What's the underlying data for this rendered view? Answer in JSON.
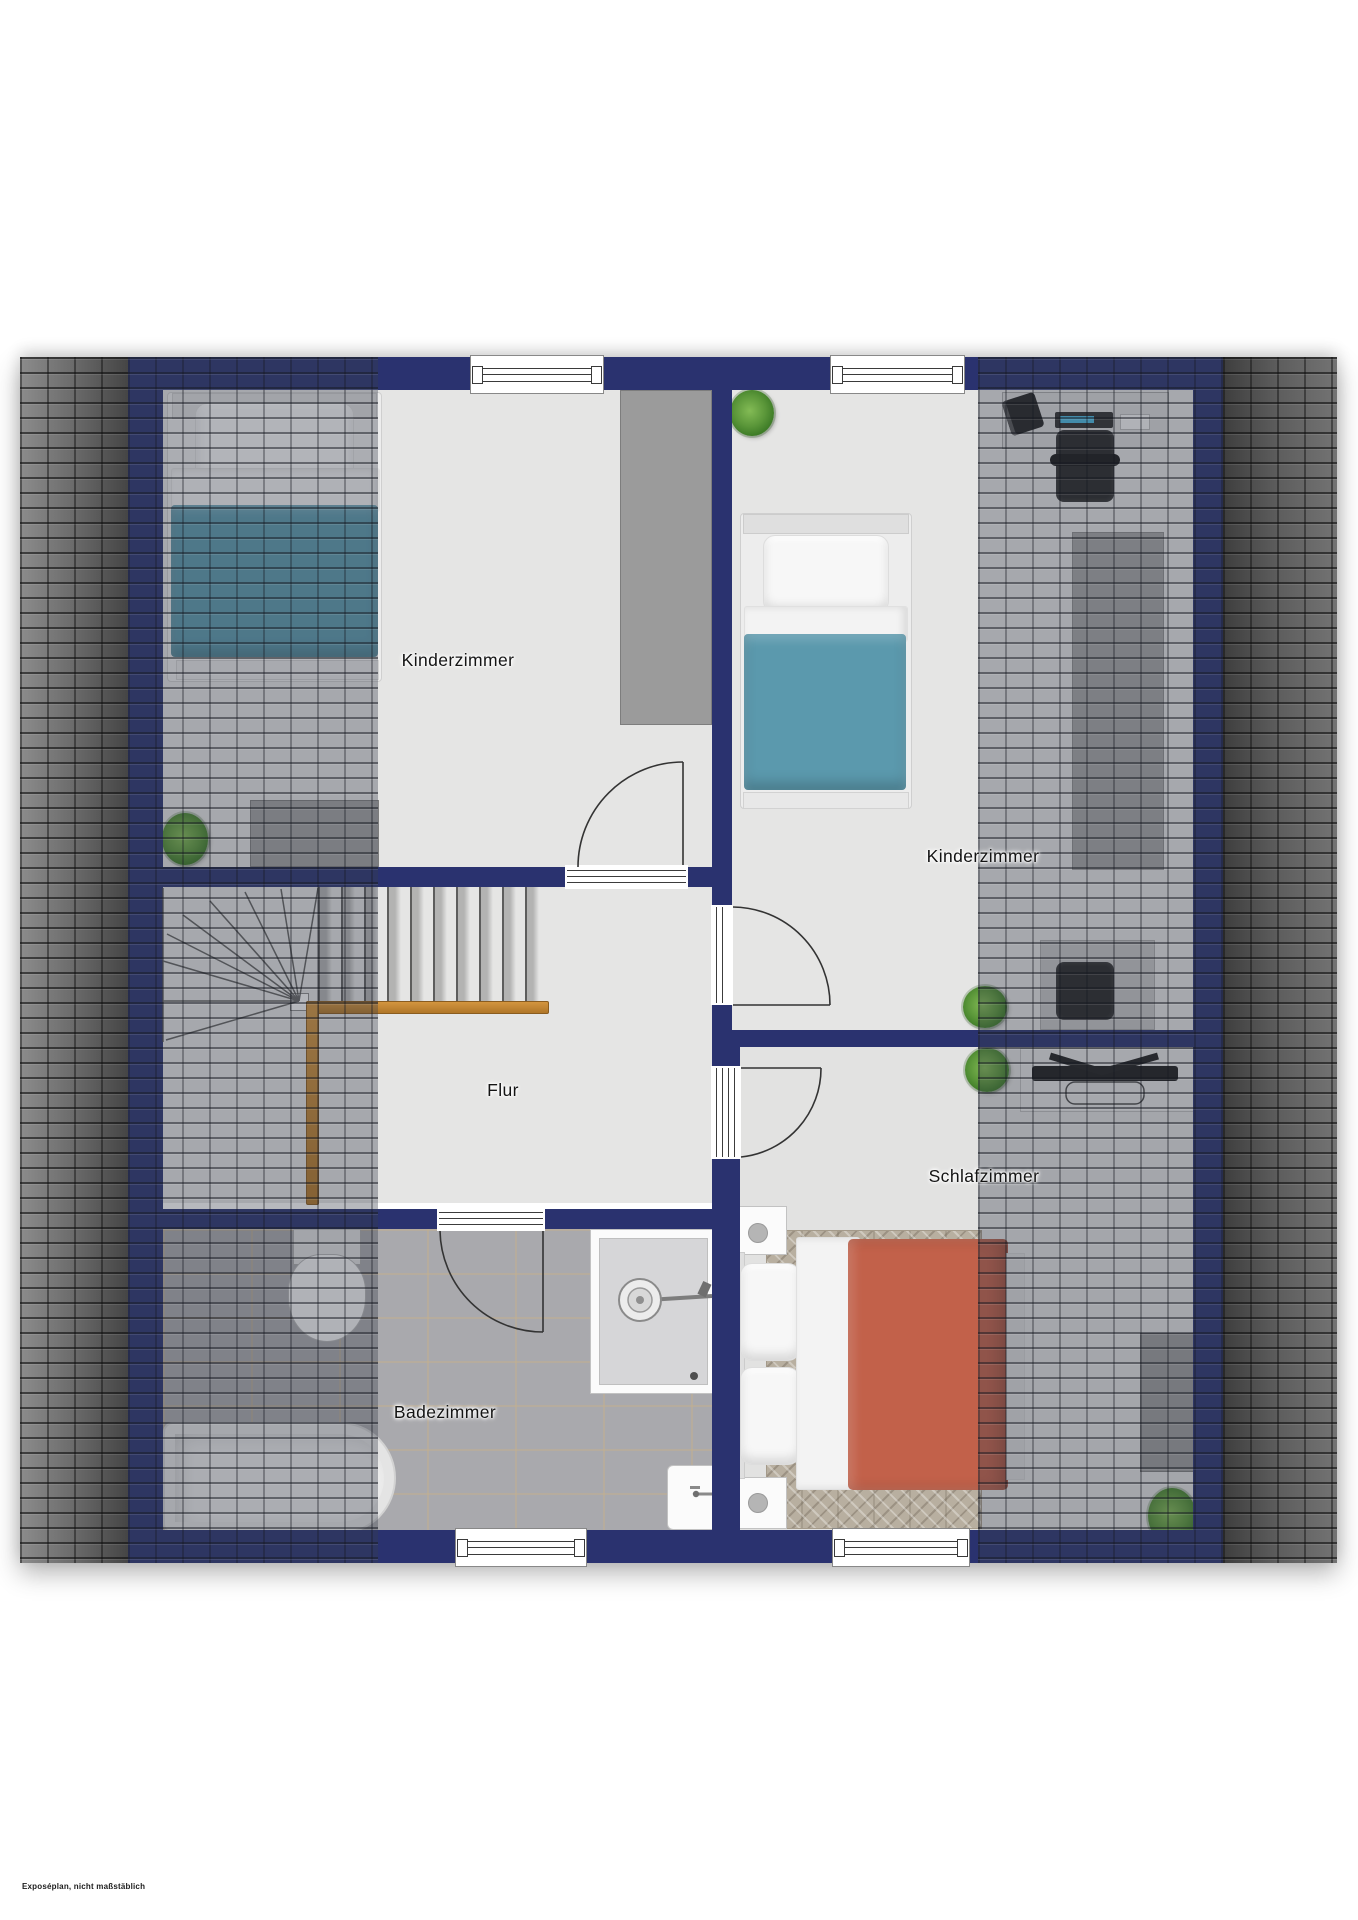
{
  "page": {
    "background": "#ffffff",
    "footer_note": "Exposéplan, nicht maßstäblich"
  },
  "floorplan": {
    "type": "attic-floor-plan-top-view",
    "labels": {
      "kinderzimmer_left": "Kinderzimmer",
      "kinderzimmer_right": "Kinderzimmer",
      "flur": "Flur",
      "schlafzimmer": "Schlafzimmer",
      "badezimmer": "Badezimmer"
    },
    "colors": {
      "wall_navy": "#2a326f",
      "floor_gray": "#e5e5e4",
      "bath_tile": "#a9a9ad",
      "roof_overlay": "#383e4c",
      "roof_exterior_dark": "#454545",
      "blanket_teal": "#5b99ad",
      "blanket_terracotta": "#c2614a",
      "handrail_wood": "#c08233",
      "plant_green": "#4e8c34"
    }
  }
}
